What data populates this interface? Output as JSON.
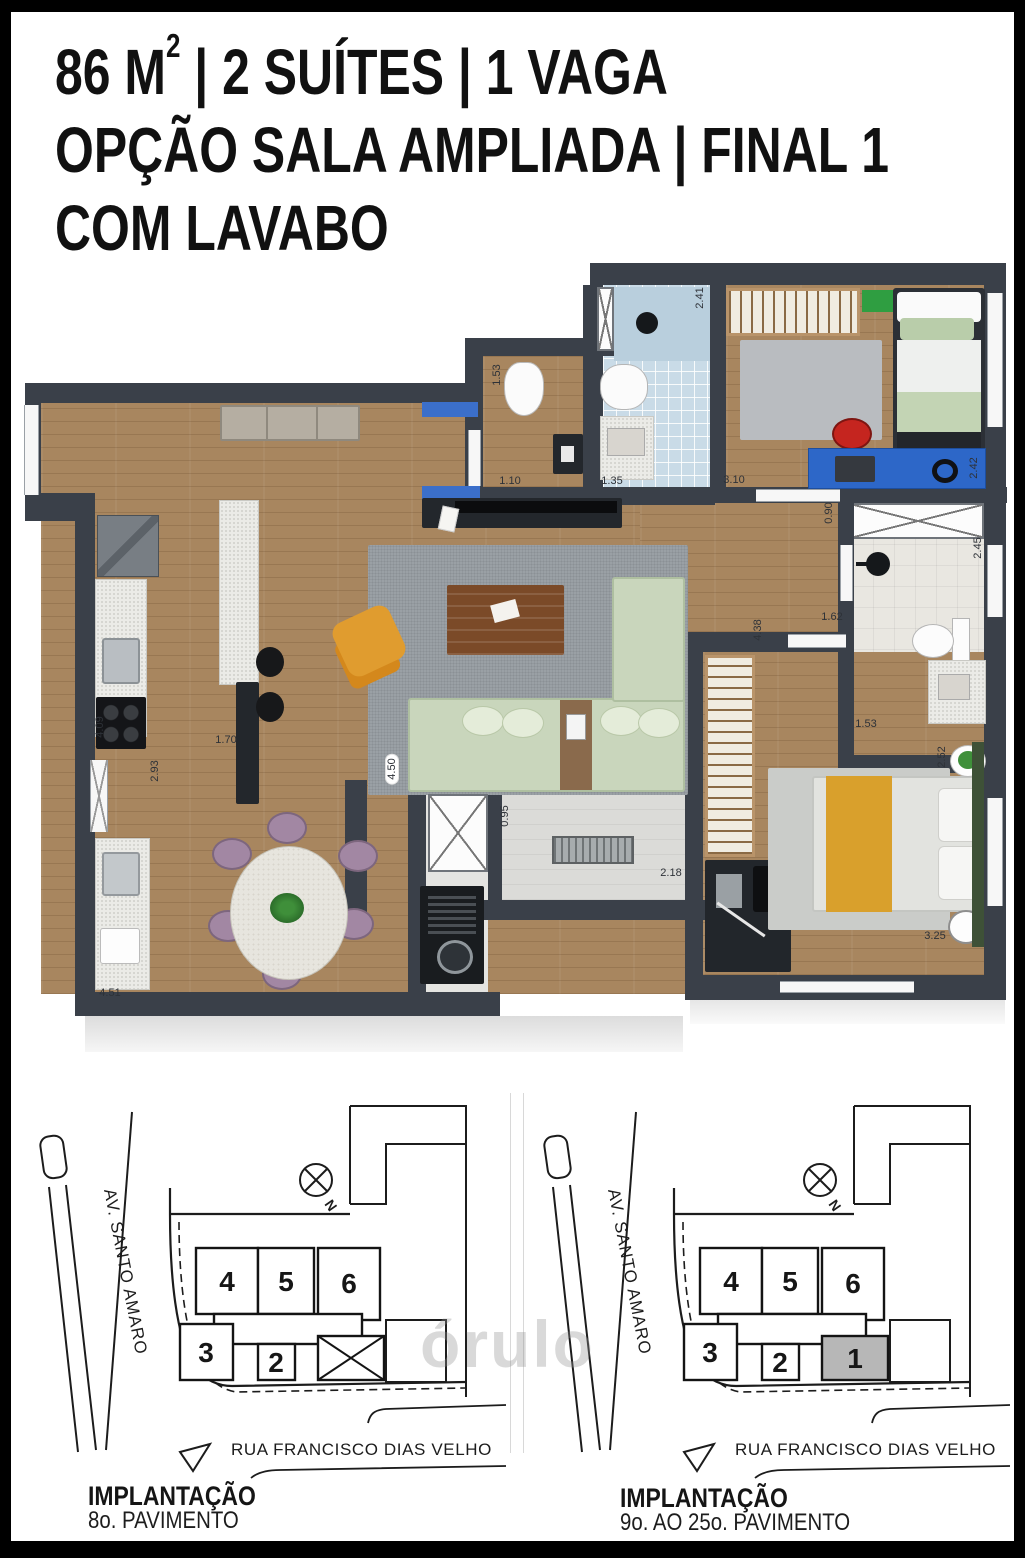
{
  "header": {
    "line1_pre": "86 M",
    "line1_sup": "2",
    "line1_post": " | 2 SUÍTES | 1 VAGA",
    "line2": "OPÇÃO SALA AMPLIADA | FINAL 1",
    "line3": "COM LAVABO"
  },
  "floor_plan": {
    "dimension_labels": [
      {
        "text": "2.41",
        "x": 700,
        "y": 298,
        "vertical": true
      },
      {
        "text": "1.53",
        "x": 497,
        "y": 375,
        "vertical": true
      },
      {
        "text": "1.10",
        "x": 510,
        "y": 481,
        "vertical": false
      },
      {
        "text": "1.35",
        "x": 612,
        "y": 481,
        "vertical": false
      },
      {
        "text": "3.10",
        "x": 734,
        "y": 480,
        "vertical": false
      },
      {
        "text": "2.42",
        "x": 974,
        "y": 468,
        "vertical": true
      },
      {
        "text": "0.90",
        "x": 829,
        "y": 513,
        "vertical": true
      },
      {
        "text": "2.45",
        "x": 978,
        "y": 548,
        "vertical": true
      },
      {
        "text": "1.62",
        "x": 832,
        "y": 617,
        "vertical": false
      },
      {
        "text": "4.38",
        "x": 758,
        "y": 630,
        "vertical": true
      },
      {
        "text": "1.53",
        "x": 866,
        "y": 724,
        "vertical": false
      },
      {
        "text": "2.52",
        "x": 942,
        "y": 757,
        "vertical": true
      },
      {
        "text": "3.25",
        "x": 935,
        "y": 936,
        "vertical": false
      },
      {
        "text": "4.50",
        "x": 392,
        "y": 769,
        "vertical": true,
        "pill": true
      },
      {
        "text": "0.95",
        "x": 505,
        "y": 816,
        "vertical": true
      },
      {
        "text": "2.18",
        "x": 671,
        "y": 873,
        "vertical": false
      },
      {
        "text": "1.70",
        "x": 226,
        "y": 740,
        "vertical": false
      },
      {
        "text": "2.93",
        "x": 155,
        "y": 771,
        "vertical": true
      },
      {
        "text": "4.09",
        "x": 100,
        "y": 727,
        "vertical": true
      },
      {
        "text": "4.51",
        "x": 110,
        "y": 993,
        "vertical": false
      }
    ],
    "colors": {
      "wall": "#3a4049",
      "wood_floor": "#a8865f",
      "bathroom_tile": "#c9dbe7",
      "accent_blue": "#3b6fca",
      "accent_sage": "#c9d6bc",
      "accent_mustard": "#d9a02c",
      "accent_purple": "#a287a3",
      "rug_gray": "#9aa0a5"
    }
  },
  "site_plans": [
    {
      "avenue_label": "AV. SANTO AMARO",
      "street_label": "RUA FRANCISCO DIAS VELHO",
      "north_label": "N",
      "units": [
        "4",
        "5",
        "6",
        "3",
        "2"
      ],
      "caption_title": "IMPLANTAÇÃO",
      "caption_subtitle": "8o. PAVIMENTO"
    },
    {
      "avenue_label": "AV. SANTO AMARO",
      "street_label": "RUA FRANCISCO DIAS VELHO",
      "north_label": "N",
      "units": [
        "4",
        "5",
        "6",
        "3",
        "2",
        "1"
      ],
      "highlighted_unit": "1",
      "caption_title": "IMPLANTAÇÃO",
      "caption_subtitle": "9o. AO 25o. PAVIMENTO"
    }
  ],
  "watermark": "órulo"
}
